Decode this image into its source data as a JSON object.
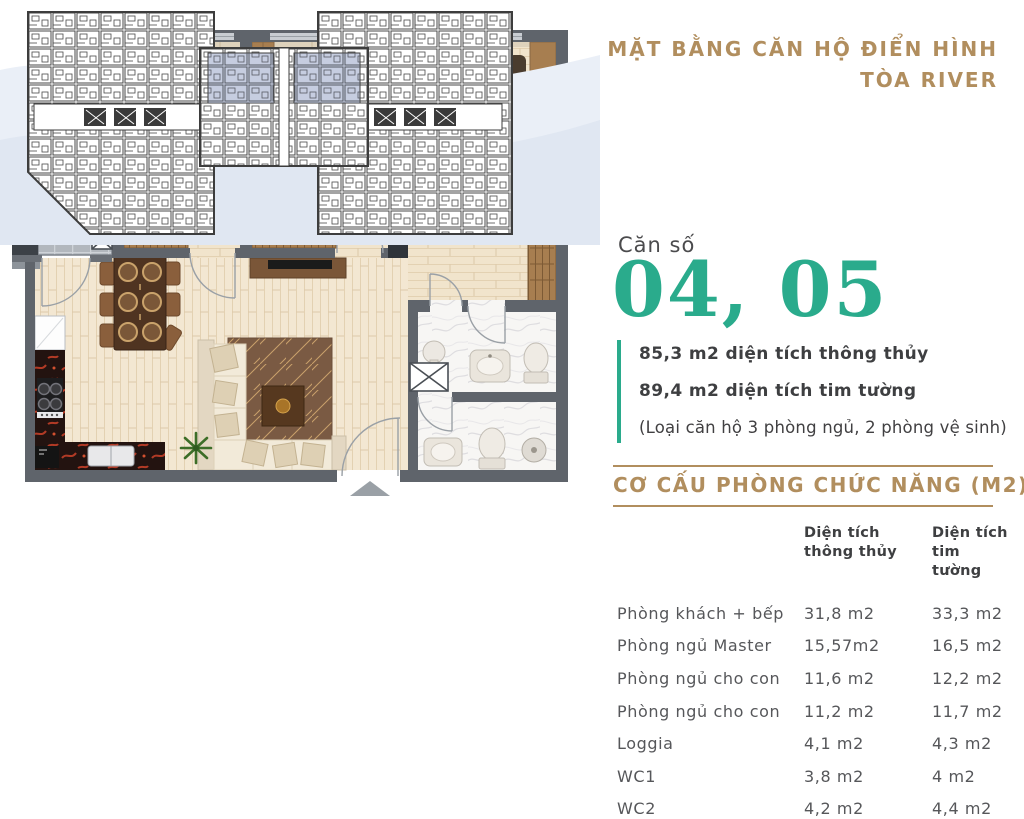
{
  "header": {
    "title_line1": "MẶT BẰNG CĂN HỘ ĐIỂN HÌNH",
    "title_line2": "TÒA RIVER"
  },
  "unit": {
    "label": "Căn số",
    "numbers": "04, 05",
    "area_line1": "85,3 m2 diện tích thông thủy",
    "area_line2": "89,4 m2 diện tích tim tường",
    "note": "(Loại căn hộ 3 phòng ngủ, 2 phòng vệ sinh)"
  },
  "section": {
    "title": "CƠ CẤU PHÒNG CHỨC NĂNG (M2)"
  },
  "table": {
    "col1": {
      "line1": "Diện tích",
      "line2": "thông thủy"
    },
    "col2": {
      "line1": "Diện tích",
      "line2": "tim tường"
    },
    "rows": [
      {
        "label": "Phòng khách + bếp",
        "tt": "31,8 m2",
        "tw": "33,3 m2"
      },
      {
        "label": "Phòng ngủ Master",
        "tt": "15,57m2",
        "tw": "16,5 m2"
      },
      {
        "label": "Phòng ngủ cho con",
        "tt": "11,6 m2",
        "tw": "12,2 m2"
      },
      {
        "label": "Phòng ngủ cho con",
        "tt": "11,2 m2",
        "tw": "11,7 m2"
      },
      {
        "label": "Loggia",
        "tt": "4,1 m2",
        "tw": "4,3 m2"
      },
      {
        "label": "WC1",
        "tt": "3,8 m2",
        "tw": "4 m2"
      },
      {
        "label": "WC2",
        "tt": "4,2 m2",
        "tw": "4,4 m2"
      }
    ]
  },
  "colors": {
    "accent_gold": "#b18e5e",
    "accent_teal": "#2aab8c",
    "text_dark": "#3e3f41",
    "text_gray": "#56575a",
    "wall_gray": "#5f646b",
    "highlight_unit": "#c6cde0"
  }
}
